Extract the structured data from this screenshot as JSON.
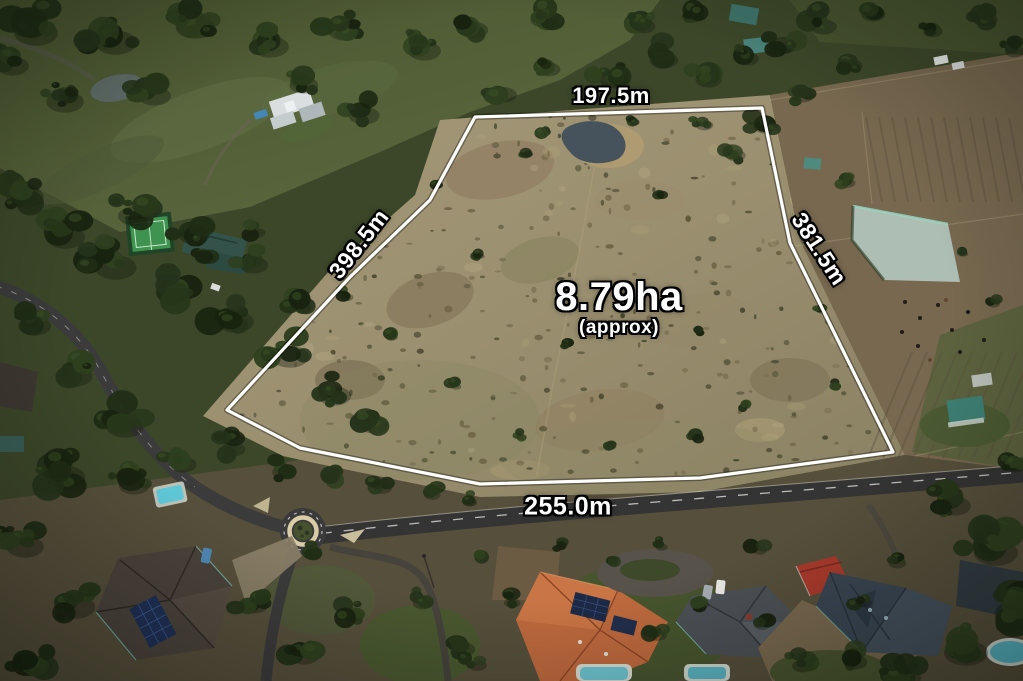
{
  "photo": {
    "type": "aerial-drone-photograph",
    "scene": "Rural acreage outlined in white, surrounded by trees, dams, paddocks, a road with a roundabout and neighbouring houses",
    "boundary_color": "#ffffff",
    "label_color": "#ffffff",
    "label_outline_color": "#000000"
  },
  "overlay": {
    "area": {
      "value": "8.79ha",
      "qualifier": "(approx)"
    },
    "sides": {
      "top": {
        "label": "197.5m"
      },
      "left": {
        "label": "398.5m"
      },
      "right": {
        "label": "381.5m"
      },
      "bottom": {
        "label": "255.0m"
      }
    }
  }
}
